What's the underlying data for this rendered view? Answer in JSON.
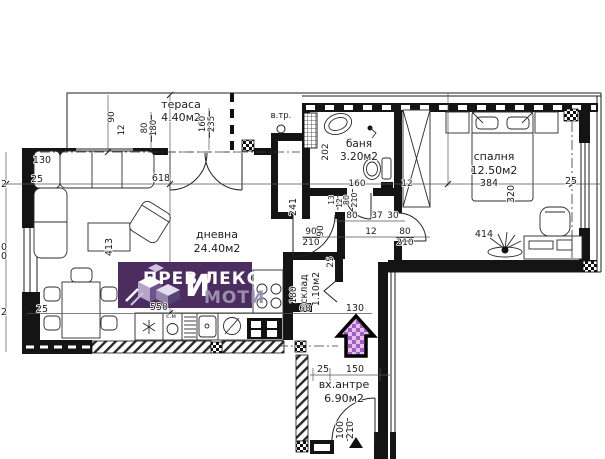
{
  "plan_meta": {
    "type": "apartment-floor-plan",
    "rooms": [
      {
        "name": "тераса",
        "area": "4.40м2"
      },
      {
        "name": "дневна",
        "area": "24.40м2"
      },
      {
        "name": "баня",
        "area": "3.20м2"
      },
      {
        "name": "спалня",
        "area": "12.50м2"
      },
      {
        "name": "склад",
        "area": "1.10м2"
      },
      {
        "name": "вх.антре",
        "area": "6.90м2"
      }
    ]
  },
  "logo": {
    "part1": "ПРЕВ",
    "big_letter": "И",
    "part2": "ЛЕКС",
    "line2": "МОТИ",
    "bg_color": "#4b2d5f",
    "text_color": "#ffffff",
    "accent_color": "#9b8fae"
  },
  "arrow": {
    "color_dark": "#a55fc0",
    "color_light": "#e0c2ec",
    "outline": "#000000"
  },
  "annotations": [
    {
      "id": "room-label-terrace",
      "text": "тераса",
      "x": 181,
      "y": 108,
      "size": 11
    },
    {
      "id": "room-area-terrace",
      "text": "4.40м2",
      "x": 181,
      "y": 121,
      "size": 11
    },
    {
      "id": "dim-label",
      "text": "90",
      "x": 114,
      "y": 117,
      "rot": -90,
      "size": 9
    },
    {
      "id": "dim-label",
      "text": "12",
      "x": 124,
      "y": 130,
      "rot": -90,
      "size": 8.5
    },
    {
      "id": "dim-label",
      "text": "80",
      "x": 147,
      "y": 128,
      "rot": -90,
      "size": 8.5
    },
    {
      "id": "dim-label",
      "text": "180",
      "x": 156,
      "y": 128,
      "rot": -90,
      "size": 8.5
    },
    {
      "id": "dim-label",
      "text": "160",
      "x": 205,
      "y": 124,
      "rot": -90,
      "size": 8.5
    },
    {
      "id": "dim-label",
      "text": "235",
      "x": 214,
      "y": 124,
      "rot": -90,
      "size": 8.5
    },
    {
      "id": "label-vtr",
      "text": "в.тр.",
      "x": 281,
      "y": 118,
      "size": 8.5
    },
    {
      "id": "dim-label",
      "text": "130",
      "x": 42,
      "y": 163,
      "size": 9.5
    },
    {
      "id": "dim-label",
      "text": "25",
      "x": 37,
      "y": 182,
      "size": 9.5
    },
    {
      "id": "dim-label",
      "text": "618",
      "x": 161,
      "y": 181,
      "size": 9.5
    },
    {
      "id": "room-label-living",
      "text": "дневна",
      "x": 217,
      "y": 238,
      "size": 11
    },
    {
      "id": "room-area-living",
      "text": "24.40м2",
      "x": 217,
      "y": 252,
      "size": 11
    },
    {
      "id": "dim-label",
      "text": "413",
      "x": 112,
      "y": 247,
      "rot": -90,
      "size": 9.5
    },
    {
      "id": "dim-label",
      "text": "25",
      "x": 42,
      "y": 312,
      "size": 9.5
    },
    {
      "id": "dim-label",
      "text": "550",
      "x": 159,
      "y": 310,
      "size": 9.5
    },
    {
      "id": "label-washing-machine",
      "text": "с.м",
      "x": 171,
      "y": 318,
      "size": 6
    },
    {
      "id": "dim-label",
      "text": "241",
      "x": 296,
      "y": 207,
      "rot": -90,
      "size": 9.5
    },
    {
      "id": "dim-partial",
      "text": "2",
      "x": 4,
      "y": 187,
      "size": 9.5
    },
    {
      "id": "dim-partial",
      "text": "0",
      "x": 4,
      "y": 250,
      "size": 9.5
    },
    {
      "id": "dim-partial",
      "text": "0",
      "x": 4,
      "y": 259,
      "size": 9.5
    },
    {
      "id": "dim-partial",
      "text": "2",
      "x": 4,
      "y": 315,
      "size": 9.5
    },
    {
      "id": "room-label-bath",
      "text": "баня",
      "x": 359,
      "y": 147,
      "size": 10.5
    },
    {
      "id": "room-area-bath",
      "text": "3.20м2",
      "x": 359,
      "y": 160,
      "size": 10.5
    },
    {
      "id": "dim-label",
      "text": "202",
      "x": 328,
      "y": 152,
      "rot": -90,
      "size": 9
    },
    {
      "id": "dim-label",
      "text": "160",
      "x": 357,
      "y": 186,
      "size": 9
    },
    {
      "id": "dim-label",
      "text": "12",
      "x": 407,
      "y": 186,
      "size": 9
    },
    {
      "id": "dim-label",
      "text": "13",
      "x": 334,
      "y": 200,
      "rot": -90,
      "size": 7.5
    },
    {
      "id": "dim-label",
      "text": "12",
      "x": 342,
      "y": 203,
      "rot": -90,
      "size": 7.5
    },
    {
      "id": "dim-label",
      "text": "80",
      "x": 349,
      "y": 200,
      "rot": -90,
      "size": 8
    },
    {
      "id": "dim-label",
      "text": "210",
      "x": 357,
      "y": 200,
      "rot": -90,
      "size": 8
    },
    {
      "id": "dim-label",
      "text": "80",
      "x": 352,
      "y": 218,
      "size": 9
    },
    {
      "id": "dim-label",
      "text": "37",
      "x": 377,
      "y": 218,
      "size": 9
    },
    {
      "id": "dim-label",
      "text": "30",
      "x": 393,
      "y": 218,
      "size": 9
    },
    {
      "id": "dim-label",
      "text": "12",
      "x": 371,
      "y": 234,
      "size": 9
    },
    {
      "id": "dim-label",
      "text": "90",
      "x": 311,
      "y": 234,
      "size": 9
    },
    {
      "id": "dim-label",
      "text": "210",
      "x": 311,
      "y": 245,
      "size": 9
    },
    {
      "id": "dim-label",
      "text": "90",
      "x": 323,
      "y": 231,
      "rot": -90,
      "size": 9
    },
    {
      "id": "dim-label",
      "text": "80",
      "x": 405,
      "y": 234,
      "size": 9
    },
    {
      "id": "dim-label",
      "text": "210",
      "x": 405,
      "y": 245,
      "size": 9
    },
    {
      "id": "dim-label",
      "text": "25",
      "x": 333,
      "y": 262,
      "rot": -90,
      "size": 9
    },
    {
      "id": "room-label-bedroom",
      "text": "спалня",
      "x": 494,
      "y": 160,
      "size": 11
    },
    {
      "id": "room-area-bedroom",
      "text": "12.50м2",
      "x": 494,
      "y": 174,
      "size": 11
    },
    {
      "id": "dim-label",
      "text": "384",
      "x": 489,
      "y": 186,
      "size": 9.5
    },
    {
      "id": "dim-label",
      "text": "320",
      "x": 514,
      "y": 194,
      "rot": -90,
      "size": 9.5
    },
    {
      "id": "dim-label",
      "text": "414",
      "x": 484,
      "y": 237,
      "size": 9.5
    },
    {
      "id": "dim-label",
      "text": "25",
      "x": 571,
      "y": 184,
      "size": 9.5
    },
    {
      "id": "room-label-storage",
      "text": "склад",
      "x": 307,
      "y": 289,
      "rot": -90,
      "size": 9.5
    },
    {
      "id": "room-area-storage",
      "text": "1.10м2",
      "x": 319,
      "y": 289,
      "rot": -90,
      "size": 9.5
    },
    {
      "id": "dim-label",
      "text": "180",
      "x": 296,
      "y": 295,
      "rot": -90,
      "size": 9
    },
    {
      "id": "dim-label",
      "text": "68",
      "x": 305,
      "y": 311,
      "size": 9
    },
    {
      "id": "dim-label",
      "text": "130",
      "x": 355,
      "y": 311,
      "size": 9.5
    },
    {
      "id": "dim-label",
      "text": "25",
      "x": 323,
      "y": 372,
      "size": 9.5
    },
    {
      "id": "dim-label",
      "text": "150",
      "x": 355,
      "y": 372,
      "size": 9.5
    },
    {
      "id": "room-label-hall",
      "text": "вх.антре",
      "x": 344,
      "y": 388,
      "size": 11
    },
    {
      "id": "room-area-hall",
      "text": "6.90м2",
      "x": 344,
      "y": 402,
      "size": 11
    },
    {
      "id": "dim-label",
      "text": "100",
      "x": 343,
      "y": 430,
      "rot": -90,
      "size": 9.5
    },
    {
      "id": "dim-label",
      "text": "210",
      "x": 353,
      "y": 430,
      "rot": -90,
      "size": 9.5
    }
  ]
}
